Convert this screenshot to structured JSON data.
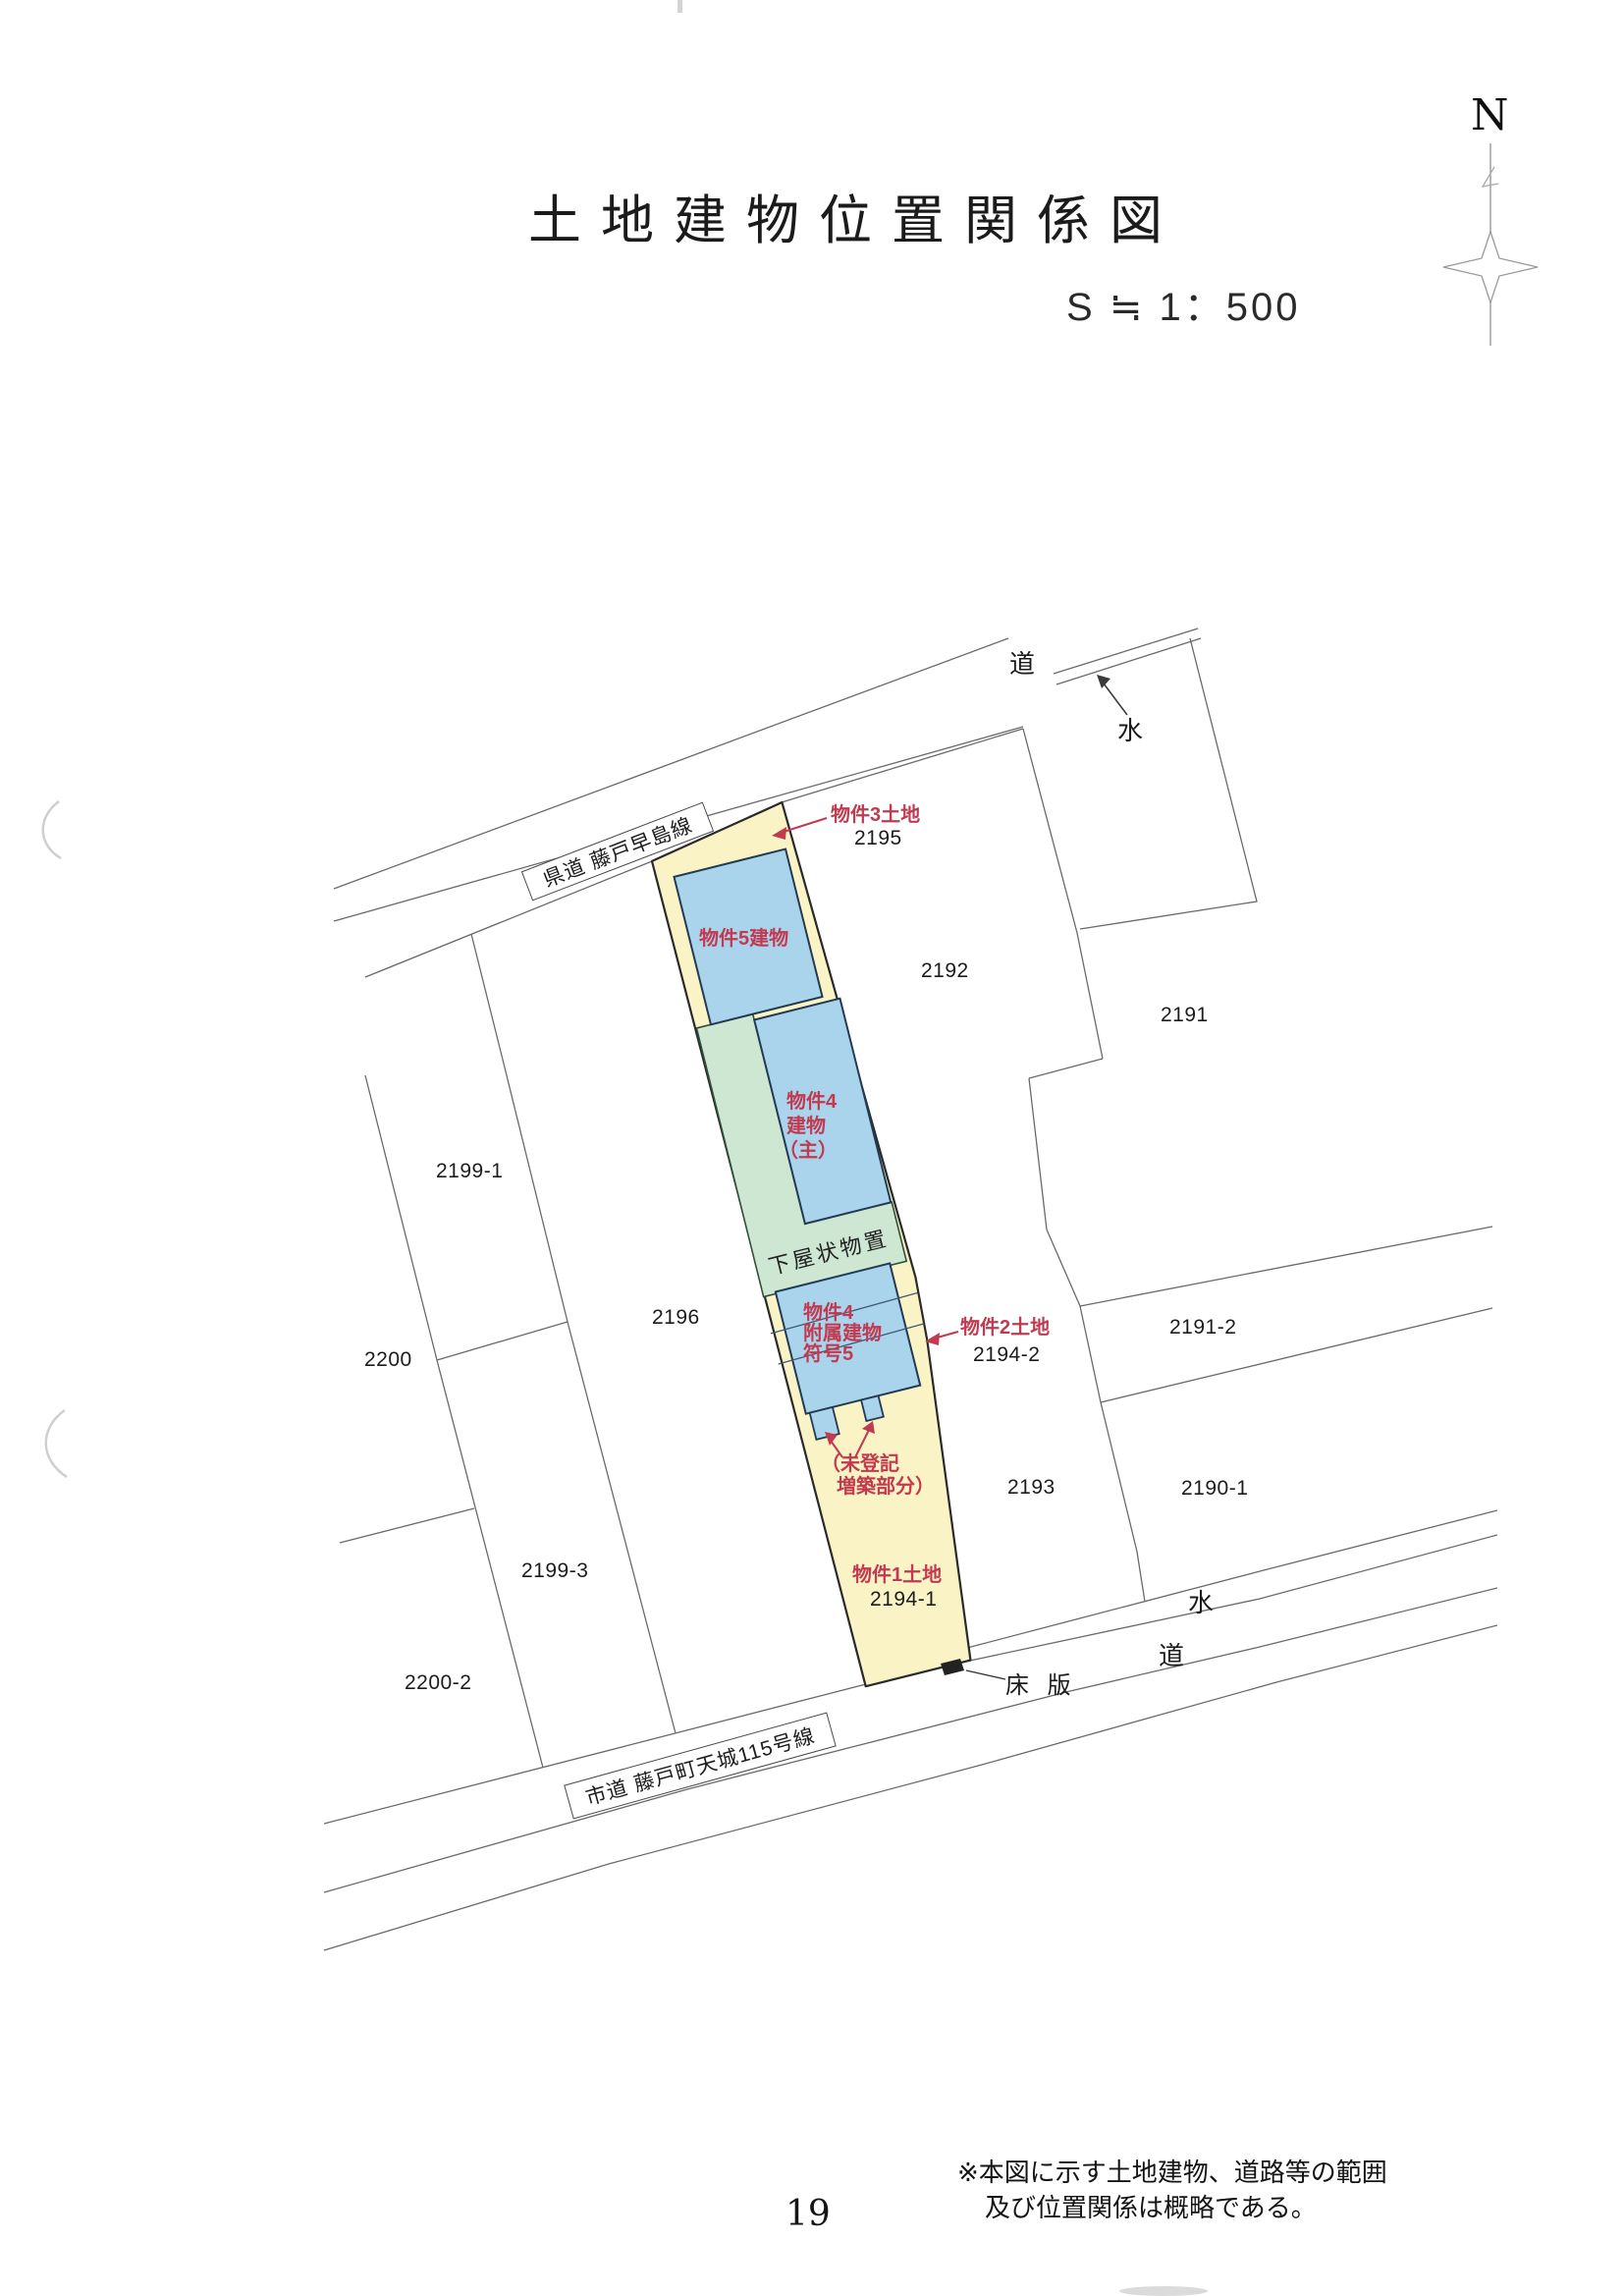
{
  "page": {
    "title": "土地建物位置関係図",
    "scale_text": "S ≒ 1：500",
    "page_number": "19",
    "note_line1": "※本図に示す土地建物、道路等の範囲",
    "note_line2": "及び位置関係は概略である。"
  },
  "compass": {
    "north_label": "N"
  },
  "roads": {
    "prefectural_road_label": "県道 藤戸早島線",
    "city_road_label": "市道 藤戸町天城115号線",
    "road_char_top": "道",
    "water_char_top": "水",
    "water_char_bottom": "水",
    "road_char_bottom": "道",
    "floor_slab_label": "床 版"
  },
  "structures": {
    "shed_label": "下屋状物置"
  },
  "red_annotations": {
    "property3_land": "物件3土地",
    "property5_building": "物件5建物",
    "property4_main_l1": "物件4",
    "property4_main_l2": "建物",
    "property4_main_l3": "（主）",
    "property4_annex_l1": "物件4",
    "property4_annex_l2": "附属建物",
    "property4_annex_l3": "符号5",
    "property2_land": "物件2土地",
    "unregistered_l1": "（未登記",
    "unregistered_l2": "増築部分）",
    "property1_land": "物件1土地"
  },
  "parcel_numbers": {
    "p2195": "2195",
    "p2192": "2192",
    "p2191": "2191",
    "p2199_1": "2199-1",
    "p2200": "2200",
    "p2196": "2196",
    "p2199_3": "2199-3",
    "p2200_2": "2200-2",
    "p2194_2": "2194-2",
    "p2191_2": "2191-2",
    "p2193": "2193",
    "p2190_1": "2190-1",
    "p2194_1": "2194-1"
  },
  "colors": {
    "annotation_red": "#c23a50",
    "building_blue": "#a9d4ec",
    "land_yellow": "#faf3c5",
    "shed_green": "#cde7d2",
    "line_gray": "#6a6a6a"
  }
}
